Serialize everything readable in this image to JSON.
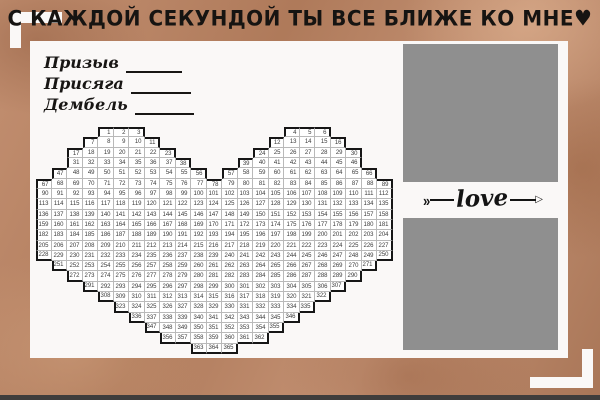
{
  "page": {
    "title": "С КАЖДОЙ СЕКУНДОЙ ТЫ ВСЕ БЛИЖЕ КО МНЕ♥"
  },
  "colors": {
    "kraft": "#bc8361",
    "panel": "#faf8f7",
    "photo": "#8f8f8f",
    "outline": "#161616",
    "grid_line": "#b9b9b9",
    "text": "#141414"
  },
  "labels": [
    {
      "text": "Призыв"
    },
    {
      "text": "Присяга"
    },
    {
      "text": "Дембель"
    }
  ],
  "love": {
    "word": "love",
    "left_chevron": "»",
    "right_arrowhead": "▷"
  },
  "calendar": {
    "total_days": 365,
    "columns": 23,
    "rows": [
      {
        "segments": [
          {
            "col": 5,
            "from": 1,
            "to": 3
          },
          {
            "col": 17,
            "from": 4,
            "to": 6
          }
        ]
      },
      {
        "segments": [
          {
            "col": 4,
            "from": 7,
            "to": 11
          },
          {
            "col": 16,
            "from": 12,
            "to": 16
          }
        ]
      },
      {
        "segments": [
          {
            "col": 3,
            "from": 17,
            "to": 23
          },
          {
            "col": 15,
            "from": 24,
            "to": 30
          }
        ]
      },
      {
        "segments": [
          {
            "col": 3,
            "from": 31,
            "to": 38
          },
          {
            "col": 14,
            "from": 39,
            "to": 46
          }
        ]
      },
      {
        "segments": [
          {
            "col": 2,
            "from": 47,
            "to": 56
          },
          {
            "col": 13,
            "from": 57,
            "to": 66
          }
        ]
      },
      {
        "segments": [
          {
            "col": 1,
            "from": 67,
            "to": 89
          }
        ]
      },
      {
        "segments": [
          {
            "col": 1,
            "from": 90,
            "to": 112
          }
        ]
      },
      {
        "segments": [
          {
            "col": 1,
            "from": 113,
            "to": 135
          }
        ]
      },
      {
        "segments": [
          {
            "col": 1,
            "from": 136,
            "to": 158
          }
        ]
      },
      {
        "segments": [
          {
            "col": 1,
            "from": 159,
            "to": 181
          }
        ]
      },
      {
        "segments": [
          {
            "col": 1,
            "from": 182,
            "to": 204
          }
        ]
      },
      {
        "segments": [
          {
            "col": 1,
            "from": 205,
            "to": 227
          }
        ]
      },
      {
        "segments": [
          {
            "col": 1,
            "from": 228,
            "to": 250
          }
        ]
      },
      {
        "segments": [
          {
            "col": 2,
            "from": 251,
            "to": 271
          }
        ]
      },
      {
        "segments": [
          {
            "col": 3,
            "from": 272,
            "to": 290
          }
        ]
      },
      {
        "segments": [
          {
            "col": 4,
            "from": 291,
            "to": 307
          }
        ]
      },
      {
        "segments": [
          {
            "col": 5,
            "from": 308,
            "to": 322
          }
        ]
      },
      {
        "segments": [
          {
            "col": 6,
            "from": 323,
            "to": 335
          }
        ]
      },
      {
        "segments": [
          {
            "col": 7,
            "from": 336,
            "to": 346
          }
        ]
      },
      {
        "segments": [
          {
            "col": 8,
            "from": 347,
            "to": 355
          }
        ]
      },
      {
        "segments": [
          {
            "col": 9,
            "from": 356,
            "to": 362
          }
        ]
      },
      {
        "segments": [
          {
            "col": 11,
            "from": 363,
            "to": 365
          }
        ]
      }
    ]
  }
}
